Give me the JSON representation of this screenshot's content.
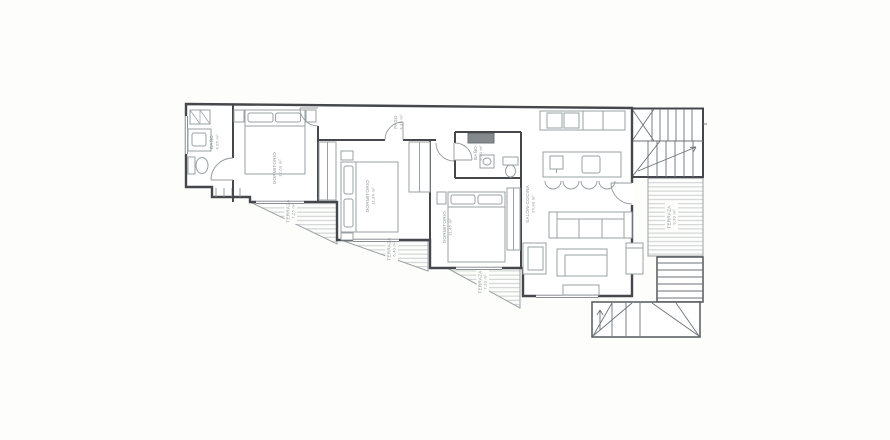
{
  "document": {
    "kind": "architectural floor plan, scanned line drawing",
    "language": "Spanish"
  },
  "style": {
    "paper": "#fdfdfc",
    "wall_color": "#45474a",
    "partition_color": "#55585b",
    "furniture_color": "#9aa0a3",
    "deck_hatch_color": "#c6c9cb",
    "label_color": "#8f9497",
    "door_arc_color": "#969a9d"
  },
  "rooms": [
    {
      "name": "BAÑO",
      "area": "4,05 m²"
    },
    {
      "name": "DORMITORIO",
      "area": "12,60 m²"
    },
    {
      "name": "PASO",
      "area": "4,35 m²"
    },
    {
      "name": "DORMITORIO",
      "area": "11,80 m²"
    },
    {
      "name": "BAÑO",
      "area": "4,20 m²"
    },
    {
      "name": "DORMITORIO",
      "area": "11,45 m²"
    },
    {
      "name": "SALÓN-COCINA",
      "area": "26,80 m²"
    }
  ],
  "terraces": [
    {
      "name": "TERRAZA",
      "area": "7,25 m²"
    },
    {
      "name": "TERRAZA",
      "area": "6,40 m²"
    },
    {
      "name": "TERRAZA",
      "area": "7,10 m²"
    },
    {
      "name": "TERRAZA",
      "area": "9,30 m²"
    }
  ],
  "features": {
    "bedrooms": 3,
    "bathrooms": 2,
    "bar_stools": 4,
    "staircases": 3
  }
}
